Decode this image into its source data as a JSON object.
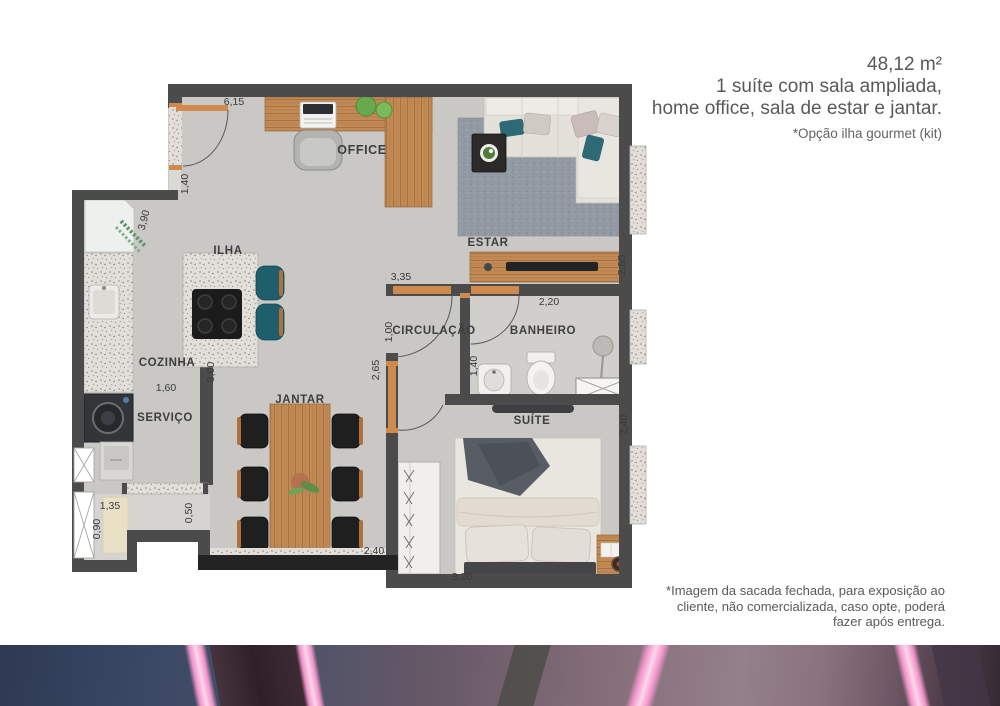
{
  "header": {
    "area": "48,12 m²",
    "description_line1": "1 suíte com sala ampliada,",
    "description_line2": "home office, sala de estar e jantar.",
    "option_note": "*Opção ilha gourmet (kit)"
  },
  "footnote": {
    "line1": "*Imagem da sacada fechada, para exposição ao",
    "line2": "cliente, não comercializada, caso opte, poderá",
    "line3": "fazer após entrega."
  },
  "plan": {
    "rooms": {
      "office": "OFFICE",
      "estar": "ESTAR",
      "ilha": "ILHA",
      "cozinha": "COZINHA",
      "servico": "SERVIÇO",
      "jantar": "JANTAR",
      "circulacao": "CIRCULAÇÃO",
      "banheiro": "BANHEIRO",
      "suite": "SUÍTE"
    },
    "dims": {
      "d6_15": "6,15",
      "d1_40_entry": "1,40",
      "d3_90": "3,90",
      "d1_60": "1,60",
      "d3_00": "3,00",
      "d1_35": "1,35",
      "d0_90": "0,90",
      "d0_50": "0,50",
      "d2_40_jantar": "2,40",
      "d3_35": "3,35",
      "d2_20": "2,20",
      "d1_00": "1,00",
      "d2_65": "2,65",
      "d1_40_bath": "1,40",
      "d2_55": "2,55",
      "d2_40_suite": "2,40",
      "d3_20": "3,20"
    }
  },
  "palette": {
    "wall": "#4b4b4b",
    "balcony_wall": "#232323",
    "wood": "#c08a55",
    "teal": "#2c6a76",
    "label": "#3e3e3e",
    "floor": "#c9c8c5",
    "pink_stripe": "#f2a0d2",
    "band_blue": "#36425c",
    "band_mauve": "#8a737e"
  }
}
